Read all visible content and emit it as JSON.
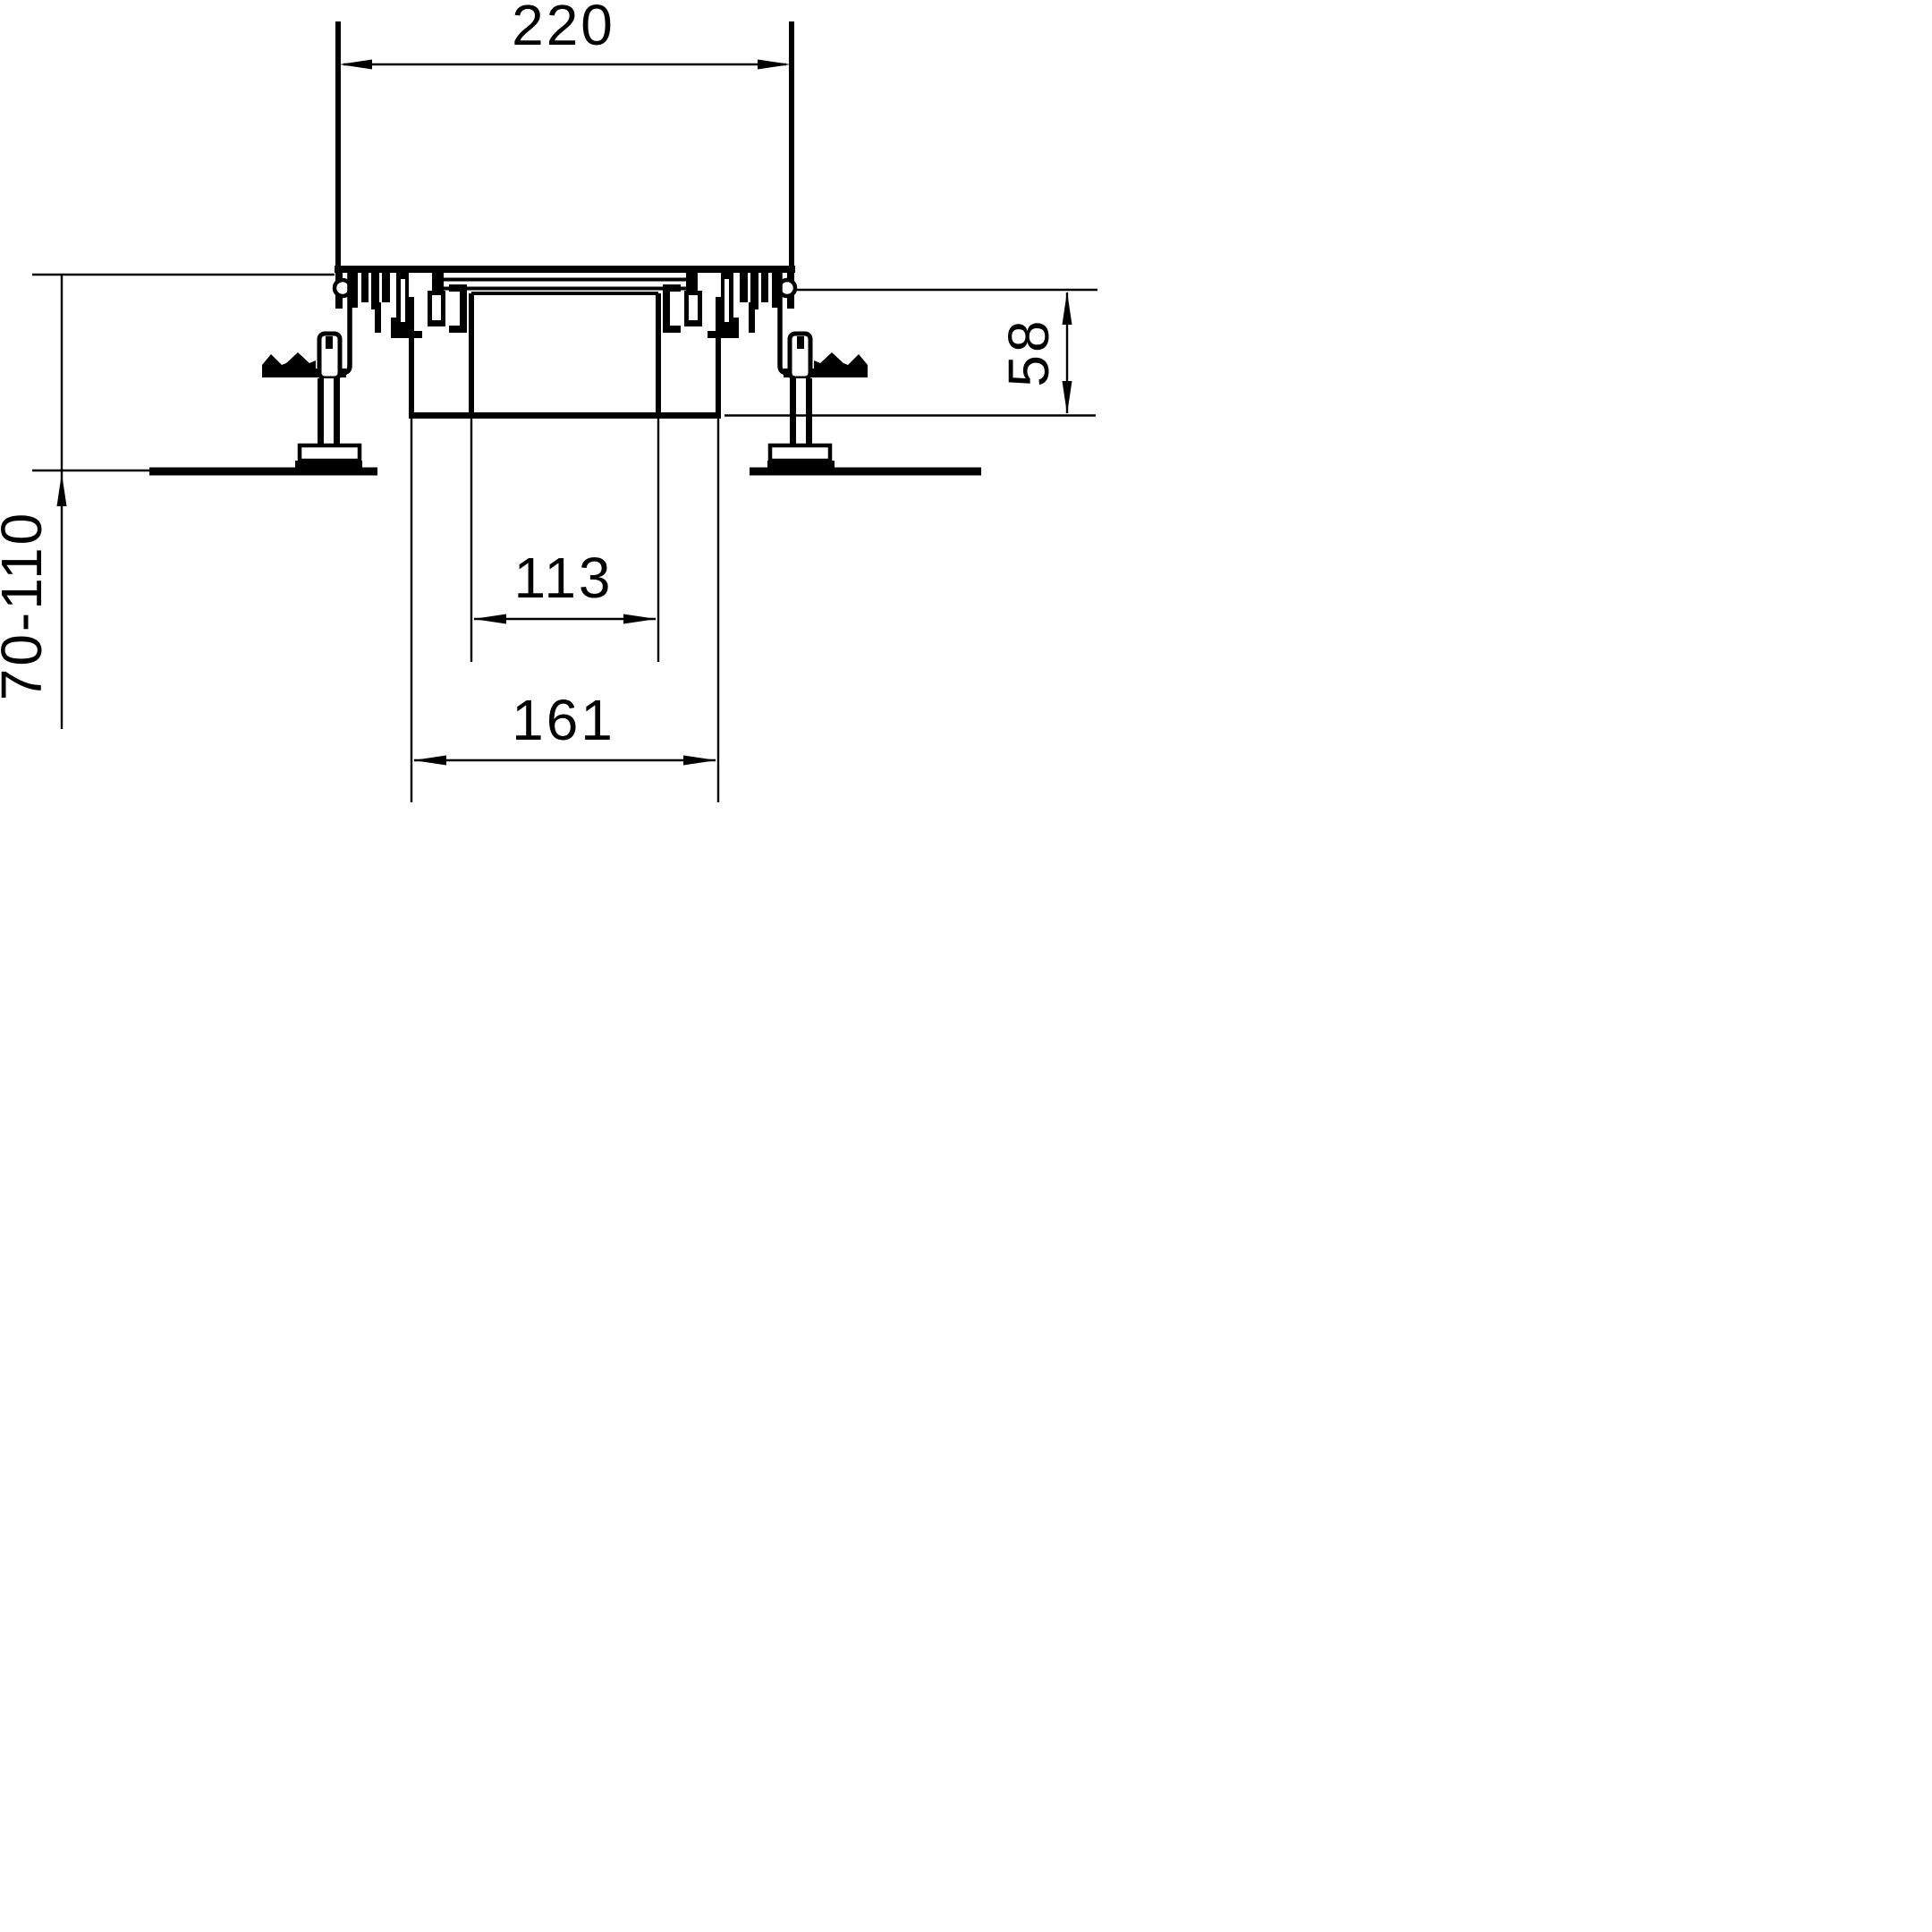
{
  "drawing": {
    "kind": "technical-cross-section",
    "line_color": "#000000",
    "background_color": "#ffffff",
    "dimensions": {
      "top_width": "220",
      "inner_width": "113",
      "outer_width": "161",
      "trim_height": "58",
      "floor_height_range": "70-110"
    }
  }
}
